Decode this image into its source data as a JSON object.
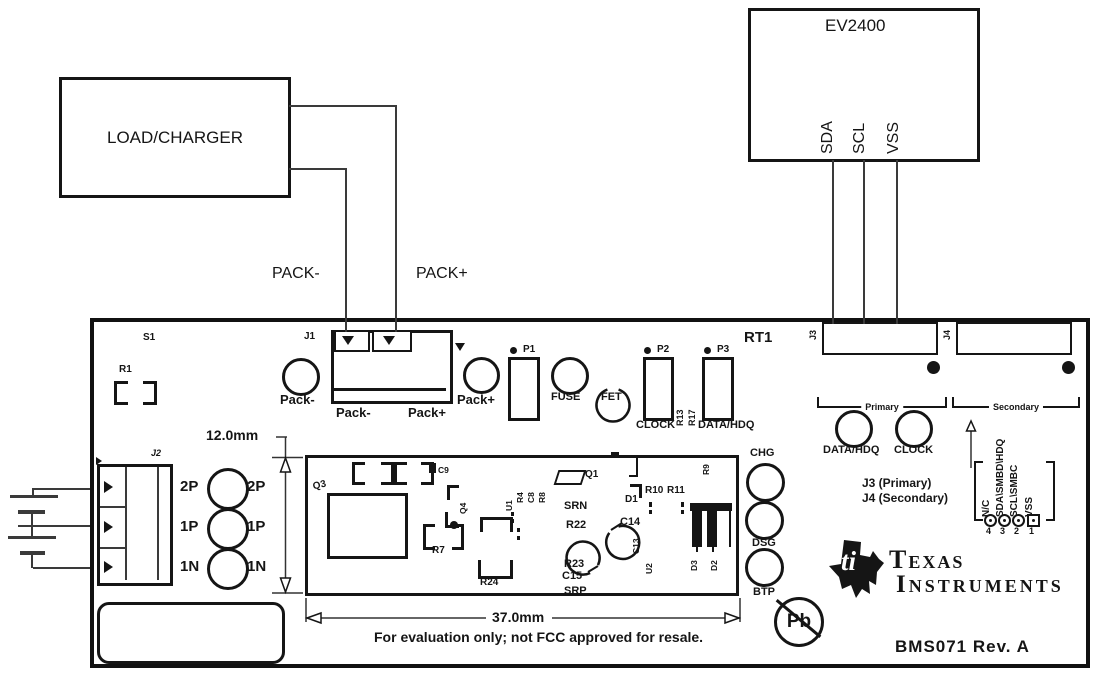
{
  "colors": {
    "ink": "#151515",
    "wire": "#3a3a3a",
    "background": "#ffffff"
  },
  "external": {
    "load_charger_label": "LOAD/CHARGER",
    "ev2400": {
      "title": "EV2400",
      "pins": [
        "SDA",
        "SCL",
        "VSS"
      ]
    },
    "pack_minus_label": "PACK-",
    "pack_plus_label": "PACK+"
  },
  "board": {
    "refs": {
      "s1": "S1",
      "r1": "R1",
      "j1": "J1",
      "j2": "J2",
      "j3": "J3",
      "j4": "J4",
      "rt1": "RT1",
      "r13": "R13",
      "r17": "R17"
    },
    "j1_pins": [
      "Pack-",
      "Pack+"
    ],
    "testpoints": {
      "pack_minus": "Pack-",
      "pack_plus": "Pack+",
      "fuse": "FUSE",
      "fet": "FET",
      "data_hdq": "DATA/HDQ",
      "clock": "CLOCK",
      "chg": "CHG",
      "dsg": "DSG",
      "btp": "BTP"
    },
    "headers": {
      "p1": "P1",
      "p2": "P2",
      "p3": "P3",
      "p2_signal": "CLOCK",
      "p3_signal": "DATA/HDQ"
    },
    "groups": {
      "primary": "Primary",
      "secondary": "Secondary"
    },
    "notes": {
      "j3": "J3 (Primary)",
      "j4": "J4 (Secondary)"
    },
    "pinout": {
      "names": [
        "N/C",
        "SDA\\SMBD\\HDQ",
        "SCL\\SMBC",
        "VSS"
      ],
      "numbers": [
        "4",
        "3",
        "2",
        "1"
      ]
    },
    "cells": {
      "left": [
        "2P",
        "1P",
        "1N"
      ],
      "right": [
        "2P",
        "1P",
        "1N"
      ]
    },
    "dimensions": {
      "height": "12.0mm",
      "width": "37.0mm"
    },
    "fcc_note": "For evaluation only; not FCC approved for resale.",
    "pb_label": "Pb",
    "brand": {
      "monogram": "ti",
      "line1": "Texas",
      "line2": "Instruments"
    },
    "rev": "BMS071 Rev. A",
    "module": {
      "q3": "Q3",
      "c9": "C9",
      "q4": "Q4",
      "u1": "U1",
      "r4": "R4",
      "c8": "C8",
      "r8": "R8",
      "r7": "R7",
      "r24": "R24",
      "q1": "Q1",
      "srn": "SRN",
      "r22": "R22",
      "c14": "C14",
      "d1": "D1",
      "r10": "R10",
      "r11": "R11",
      "c13": "C13",
      "u2": "U2",
      "r23": "R23",
      "c15": "C15",
      "srp": "SRP",
      "d3": "D3",
      "d2": "D2",
      "r9": "R9"
    }
  }
}
